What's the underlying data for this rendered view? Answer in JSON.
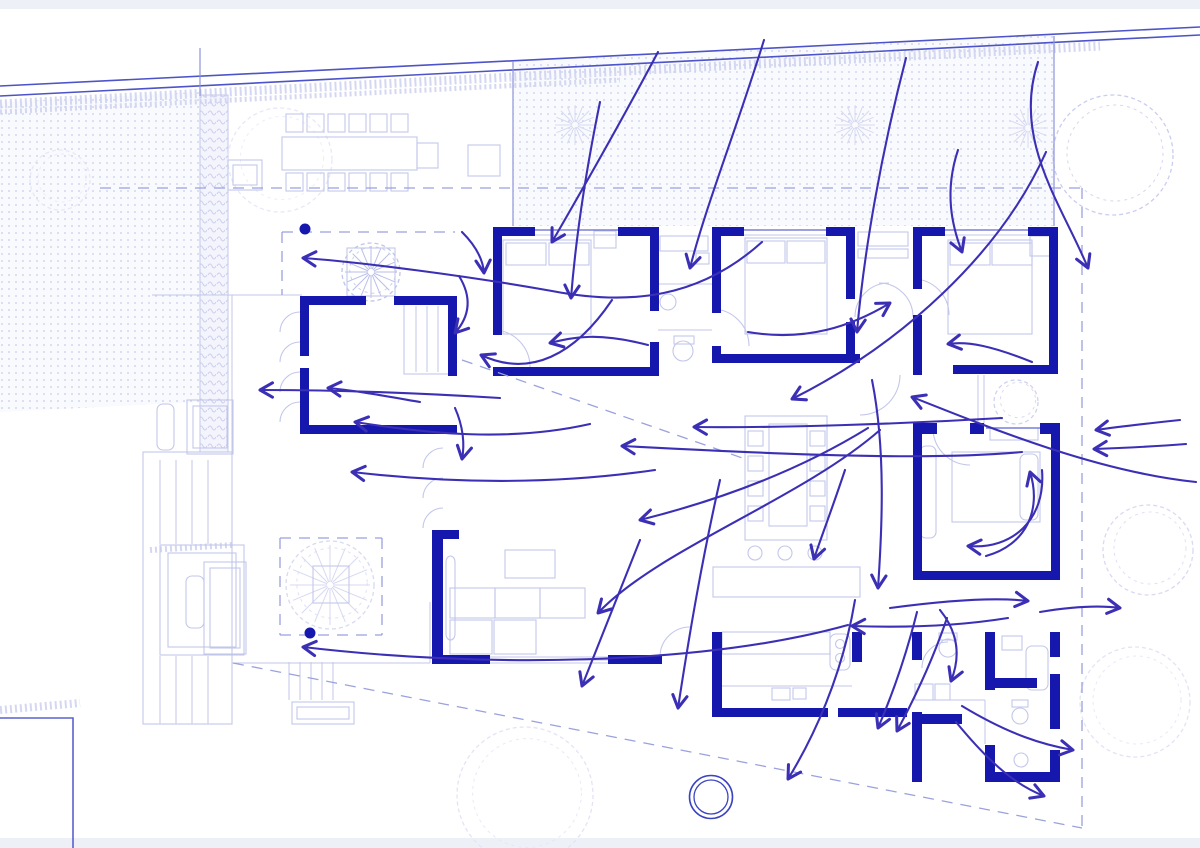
{
  "meta": {
    "description": "architectural site / floor plan with circulation flow arrows",
    "width": 1200,
    "height": 848
  },
  "palette": {
    "wall": "#1517ad",
    "arrow": "#3b2fb5",
    "furniture": "#c3c7e9",
    "furniture_faint": "#d9dcf2",
    "site_line": "#4d53c8",
    "mid_line": "#8d93da",
    "dashed": "#9aa1de",
    "dot": "#c7cbec",
    "dot_bg": "#f9fafd",
    "hedge": "#ccd0ee",
    "band": "#eef0f8",
    "feature": "#3a43c0"
  },
  "bands": [
    [
      0,
      0,
      1200,
      9
    ],
    [
      0,
      838,
      1200,
      10
    ]
  ],
  "dotted_areas": [
    {
      "points": "0,102 200,92 200,402 0,412"
    },
    {
      "points": "513,62 1054,35 1054,226 513,226"
    }
  ],
  "hedge_strip": {
    "rect": [
      200,
      95,
      28,
      357
    ]
  },
  "hedge_scribbles": [
    {
      "d": "M0,104 L1100,46",
      "w": 9
    },
    {
      "d": "M0,112 L620,80",
      "w": 5
    },
    {
      "d": "M0,710 L80,703",
      "w": 8
    },
    {
      "d": "M150,550 L232,545",
      "w": 6
    }
  ],
  "boundary_lines": [
    [
      0,
      86,
      1200,
      27
    ],
    [
      0,
      96,
      1200,
      35
    ]
  ],
  "mid_lines": [
    [
      513,
      62,
      513,
      226
    ],
    [
      1054,
      36,
      1054,
      226
    ],
    [
      200,
      48,
      200,
      96
    ]
  ],
  "pool": {
    "points": "0,718 73,718 73,848"
  },
  "feature_circle": {
    "cx": 711,
    "cy": 797,
    "r_outer": 21.5,
    "r_inner": 17
  },
  "dashed_lines": [
    [
      100,
      188,
      1082,
      188
    ],
    [
      1082,
      188,
      1082,
      828
    ],
    [
      233,
      663,
      1082,
      828
    ],
    [
      462,
      360,
      748,
      460
    ],
    [
      282,
      232,
      455,
      232
    ],
    [
      282,
      232,
      282,
      295
    ],
    [
      280,
      538,
      382,
      538
    ],
    [
      382,
      538,
      382,
      635
    ],
    [
      280,
      635,
      382,
      635
    ],
    [
      280,
      538,
      280,
      635
    ]
  ],
  "walls": [
    [
      300,
      296,
      66,
      9
    ],
    [
      394,
      296,
      63,
      9
    ],
    [
      300,
      296,
      9,
      60
    ],
    [
      300,
      368,
      9,
      66
    ],
    [
      300,
      425,
      157,
      9
    ],
    [
      448,
      296,
      9,
      80
    ],
    [
      493,
      227,
      42,
      9
    ],
    [
      618,
      227,
      40,
      9
    ],
    [
      493,
      227,
      9,
      108
    ],
    [
      493,
      367,
      165,
      9
    ],
    [
      650,
      227,
      9,
      84
    ],
    [
      650,
      342,
      9,
      34
    ],
    [
      712,
      227,
      32,
      9
    ],
    [
      826,
      227,
      29,
      9
    ],
    [
      712,
      227,
      9,
      86
    ],
    [
      712,
      346,
      9,
      17
    ],
    [
      712,
      354,
      148,
      9
    ],
    [
      846,
      227,
      9,
      72
    ],
    [
      846,
      322,
      9,
      41
    ],
    [
      913,
      227,
      32,
      9
    ],
    [
      1028,
      227,
      30,
      9
    ],
    [
      913,
      227,
      9,
      62
    ],
    [
      913,
      315,
      9,
      60
    ],
    [
      953,
      365,
      105,
      9
    ],
    [
      1049,
      227,
      9,
      147
    ],
    [
      913,
      423,
      24,
      11
    ],
    [
      970,
      423,
      14,
      11
    ],
    [
      1040,
      423,
      20,
      11
    ],
    [
      913,
      434,
      9,
      137
    ],
    [
      1051,
      434,
      9,
      146
    ],
    [
      913,
      571,
      147,
      9
    ],
    [
      432,
      530,
      11,
      127
    ],
    [
      443,
      530,
      16,
      9
    ],
    [
      432,
      655,
      58,
      9
    ],
    [
      608,
      655,
      54,
      9
    ],
    [
      712,
      632,
      10,
      85
    ],
    [
      712,
      708,
      28,
      9
    ],
    [
      740,
      708,
      88,
      9
    ],
    [
      838,
      708,
      69,
      9
    ],
    [
      852,
      632,
      10,
      30
    ],
    [
      912,
      632,
      10,
      28
    ],
    [
      912,
      712,
      10,
      70
    ],
    [
      922,
      714,
      40,
      10
    ],
    [
      985,
      632,
      10,
      58
    ],
    [
      990,
      678,
      47,
      10
    ],
    [
      1050,
      632,
      10,
      25
    ],
    [
      1050,
      674,
      10,
      55
    ],
    [
      985,
      745,
      10,
      37
    ],
    [
      985,
      772,
      75,
      10
    ],
    [
      1050,
      750,
      10,
      32
    ]
  ],
  "window_lines": [
    [
      535,
      230,
      618,
      230
    ],
    [
      744,
      230,
      826,
      230
    ],
    [
      945,
      230,
      1028,
      230
    ],
    [
      986,
      428,
      1040,
      428
    ]
  ],
  "window_lines_faint": [
    [
      535,
      235,
      618,
      235
    ],
    [
      744,
      235,
      826,
      235
    ],
    [
      945,
      235,
      1028,
      235
    ],
    [
      490,
      657,
      608,
      657
    ],
    [
      490,
      660,
      608,
      660
    ],
    [
      490,
      663,
      608,
      663
    ]
  ],
  "furniture_rects": [
    [
      282,
      137,
      135,
      33
    ],
    [
      417,
      143,
      21,
      25
    ],
    [
      286,
      114,
      17,
      18
    ],
    [
      307,
      114,
      17,
      18
    ],
    [
      328,
      114,
      17,
      18
    ],
    [
      349,
      114,
      17,
      18
    ],
    [
      370,
      114,
      17,
      18
    ],
    [
      391,
      114,
      17,
      18
    ],
    [
      286,
      173,
      17,
      18
    ],
    [
      307,
      173,
      17,
      18
    ],
    [
      328,
      173,
      17,
      18
    ],
    [
      349,
      173,
      17,
      18
    ],
    [
      370,
      173,
      17,
      18
    ],
    [
      391,
      173,
      17,
      18
    ],
    [
      468,
      145,
      32,
      31
    ],
    [
      228,
      160,
      34,
      30
    ],
    [
      233,
      165,
      24,
      20
    ],
    [
      347,
      248,
      48,
      48
    ],
    [
      503,
      240,
      88,
      94
    ],
    [
      506,
      243,
      40,
      22
    ],
    [
      549,
      243,
      40,
      22
    ],
    [
      594,
      231,
      22,
      17
    ],
    [
      660,
      236,
      48,
      15
    ],
    [
      696,
      253,
      13,
      11
    ],
    [
      745,
      238,
      82,
      96
    ],
    [
      747,
      241,
      38,
      22
    ],
    [
      787,
      241,
      38,
      22
    ],
    [
      858,
      232,
      50,
      14
    ],
    [
      858,
      249,
      50,
      9
    ],
    [
      948,
      240,
      84,
      94
    ],
    [
      950,
      243,
      40,
      22
    ],
    [
      992,
      243,
      40,
      22
    ],
    [
      1030,
      236,
      22,
      20
    ],
    [
      404,
      304,
      45,
      70
    ],
    [
      745,
      416,
      82,
      124
    ],
    [
      769,
      424,
      38,
      102
    ],
    [
      748,
      431,
      15,
      15
    ],
    [
      748,
      456,
      15,
      15
    ],
    [
      748,
      481,
      15,
      15
    ],
    [
      748,
      506,
      15,
      15
    ],
    [
      810,
      431,
      15,
      15
    ],
    [
      810,
      456,
      15,
      15
    ],
    [
      810,
      481,
      15,
      15
    ],
    [
      810,
      506,
      15,
      15
    ],
    [
      713,
      567,
      147,
      30
    ],
    [
      450,
      588,
      45,
      30
    ],
    [
      495,
      588,
      45,
      30
    ],
    [
      540,
      588,
      45,
      30
    ],
    [
      450,
      620,
      42,
      34
    ],
    [
      494,
      620,
      42,
      34
    ],
    [
      505,
      550,
      50,
      28
    ],
    [
      446,
      556,
      9,
      84
    ],
    [
      722,
      632,
      108,
      22
    ],
    [
      830,
      634,
      20,
      36
    ],
    [
      772,
      688,
      18,
      12
    ],
    [
      793,
      688,
      13,
      11
    ],
    [
      952,
      452,
      88,
      70
    ],
    [
      1020,
      454,
      18,
      66
    ],
    [
      920,
      446,
      16,
      92
    ],
    [
      990,
      428,
      48,
      12
    ],
    [
      915,
      684,
      18,
      16
    ],
    [
      935,
      684,
      15,
      16
    ],
    [
      1026,
      646,
      22,
      44
    ],
    [
      1002,
      636,
      20,
      14
    ],
    [
      674,
      336,
      20,
      8
    ],
    [
      939,
      633,
      18,
      7
    ],
    [
      1012,
      700,
      16,
      7
    ],
    [
      292,
      702,
      62,
      22
    ],
    [
      297,
      707,
      52,
      12
    ],
    [
      143,
      452,
      89,
      272
    ],
    [
      160,
      545,
      84,
      110
    ],
    [
      168,
      553,
      68,
      94
    ],
    [
      204,
      562,
      42,
      92
    ],
    [
      210,
      568,
      30,
      80
    ],
    [
      186,
      576,
      18,
      52
    ],
    [
      187,
      400,
      46,
      54
    ],
    [
      193,
      406,
      34,
      42
    ],
    [
      157,
      404,
      17,
      46
    ],
    [
      313,
      566,
      36,
      37
    ]
  ],
  "furniture_lines": [
    [
      152,
      295,
      302,
      295
    ],
    [
      232,
      295,
      232,
      663
    ],
    [
      232,
      663,
      430,
      663
    ],
    [
      430,
      602,
      430,
      663
    ],
    [
      978,
      375,
      978,
      424
    ],
    [
      984,
      375,
      984,
      424
    ],
    [
      712,
      686,
      852,
      686
    ],
    [
      922,
      700,
      985,
      700
    ],
    [
      985,
      700,
      985,
      744
    ],
    [
      658,
      284,
      712,
      284
    ],
    [
      658,
      330,
      712,
      330
    ],
    [
      416,
      306,
      416,
      372
    ],
    [
      427,
      306,
      427,
      372
    ],
    [
      438,
      306,
      438,
      372
    ],
    [
      289,
      662,
      289,
      700
    ],
    [
      300,
      662,
      300,
      700
    ],
    [
      311,
      662,
      311,
      700
    ],
    [
      322,
      662,
      322,
      700
    ],
    [
      333,
      662,
      333,
      700
    ],
    [
      160,
      460,
      160,
      544
    ],
    [
      176,
      460,
      176,
      544
    ],
    [
      192,
      460,
      192,
      544
    ],
    [
      208,
      460,
      208,
      544
    ],
    [
      160,
      656,
      160,
      724
    ],
    [
      176,
      656,
      176,
      724
    ],
    [
      192,
      656,
      192,
      724
    ],
    [
      208,
      656,
      208,
      724
    ]
  ],
  "door_arcs": [
    "M300,312 a20,20 0 0 0 -20,20",
    "M300,342 a20,20 0 0 0 -20,20",
    "M300,372 a20,20 0 0 0 -20,20",
    "M300,402 a20,20 0 0 0 -20,20",
    "M443,448 a20,20 0 0 0 -20,20",
    "M443,478 a20,20 0 0 0 -20,20",
    "M443,508 a20,20 0 0 0 -20,20",
    "M493,330 A37,37 0 0 1 530,367",
    "M712,309 A37,37 0 0 1 749,346",
    "M913,279 A36,36 0 0 1 949,315",
    "M933,428 A37,37 0 0 0 970,465",
    "M889,283 A34,34 0 0 0 855,317",
    "M879,283 A34,34 0 0 1 913,317",
    "M860,415 A40,40 0 0 0 900,375",
    "M660,657 A30,30 0 0 1 690,627",
    "M948,642 A26,26 0 0 0 922,668"
  ],
  "furniture_circles": [
    [
      755,
      553,
      7
    ],
    [
      785,
      553,
      7
    ],
    [
      815,
      553,
      7
    ],
    [
      683,
      351,
      10
    ],
    [
      668,
      302,
      8
    ],
    [
      948,
      648,
      9
    ],
    [
      1020,
      716,
      8
    ],
    [
      1021,
      760,
      7
    ],
    [
      840,
      644,
      4.5
    ],
    [
      840,
      658,
      4.5
    ]
  ],
  "trees": [
    {
      "cx": 1113,
      "cy": 155,
      "r": 60,
      "color": "#c9cdee"
    },
    {
      "cx": 1148,
      "cy": 550,
      "r": 45,
      "color": "#d7daf1"
    },
    {
      "cx": 1135,
      "cy": 702,
      "r": 55,
      "color": "#e2e4f5"
    },
    {
      "cx": 525,
      "cy": 795,
      "r": 68,
      "color": "#e2e4f5"
    },
    {
      "cx": 280,
      "cy": 160,
      "r": 52,
      "color": "#e6e8f7"
    },
    {
      "cx": 60,
      "cy": 180,
      "r": 30,
      "color": "#e6e8f7"
    },
    {
      "cx": 1016,
      "cy": 402,
      "r": 22,
      "color": "#cfd3ef"
    },
    {
      "cx": 371,
      "cy": 272,
      "r": 29,
      "color": "#bfc4e9"
    },
    {
      "cx": 330,
      "cy": 585,
      "r": 44,
      "color": "#d7daf1"
    }
  ],
  "starbursts": [
    {
      "cx": 575,
      "cy": 125,
      "r": 20,
      "color": "#d7daf1"
    },
    {
      "cx": 855,
      "cy": 125,
      "r": 20,
      "color": "#d7daf1"
    },
    {
      "cx": 1028,
      "cy": 128,
      "r": 20,
      "color": "#d7daf1"
    },
    {
      "cx": 371,
      "cy": 272,
      "r": 26,
      "color": "#b9bfe8"
    },
    {
      "cx": 330,
      "cy": 585,
      "r": 40,
      "color": "#d7daf1"
    }
  ],
  "survey_dots": [
    [
      305,
      229,
      5.5
    ],
    [
      310,
      633,
      5.5
    ]
  ],
  "flow_arrows": [
    "M658,52 C622,120 585,185 552,242",
    "M764,40 C738,125 706,205 690,268",
    "M600,102 C583,185 575,248 571,298",
    "M906,58 C882,150 864,250 857,332",
    "M958,150 C944,192 952,226 962,252",
    "M1038,62 C1012,140 1062,205 1088,268",
    "M1046,152 C1000,255 900,345 792,399",
    "M762,242 C700,298 630,306 552,291 C468,276 360,262 303,258",
    "M462,232 C476,246 483,259 484,273",
    "M459,276 C472,297 470,316 455,333",
    "M648,345 C598,332 574,337 550,343",
    "M612,300 C575,355 530,378 481,355",
    "M500,398 C420,393 330,390 260,390",
    "M420,402 C385,396 352,390 328,388",
    "M590,424 C510,442 430,434 355,422",
    "M655,470 C540,487 430,481 352,472",
    "M455,408 C463,426 465,444 462,459",
    "M1002,418 C900,424 780,428 694,427",
    "M1022,452 C920,462 740,452 622,446",
    "M880,430 C800,500 660,548 598,613",
    "M868,428 C800,470 720,500 640,520",
    "M720,480 C702,560 690,630 678,708",
    "M640,540 C616,600 596,650 582,686",
    "M845,470 C830,515 820,540 814,559",
    "M872,380 C886,450 882,530 878,588",
    "M855,600 C842,678 812,740 788,779",
    "M890,608 C950,600 996,597 1028,601",
    "M1040,612 C1070,607 1098,605 1120,608",
    "M1042,470 C1046,520 1012,550 968,546",
    "M986,556 C1026,545 1042,510 1030,472",
    "M1032,362 C992,346 968,341 948,344",
    "M748,332 C806,342 852,326 890,303",
    "M1196,482 C1100,472 1000,432 912,397",
    "M1180,420 C1142,424 1116,427 1096,430",
    "M1186,444 C1148,447 1120,448 1094,449",
    "M848,625 C700,666 480,668 303,647",
    "M1008,618 C958,626 906,628 852,626",
    "M917,612 C905,660 890,700 878,728",
    "M947,618 C931,665 911,705 897,731",
    "M940,610 C961,636 959,661 951,681",
    "M962,706 C1010,735 1044,745 1073,750",
    "M956,722 C992,766 1018,786 1044,796"
  ]
}
